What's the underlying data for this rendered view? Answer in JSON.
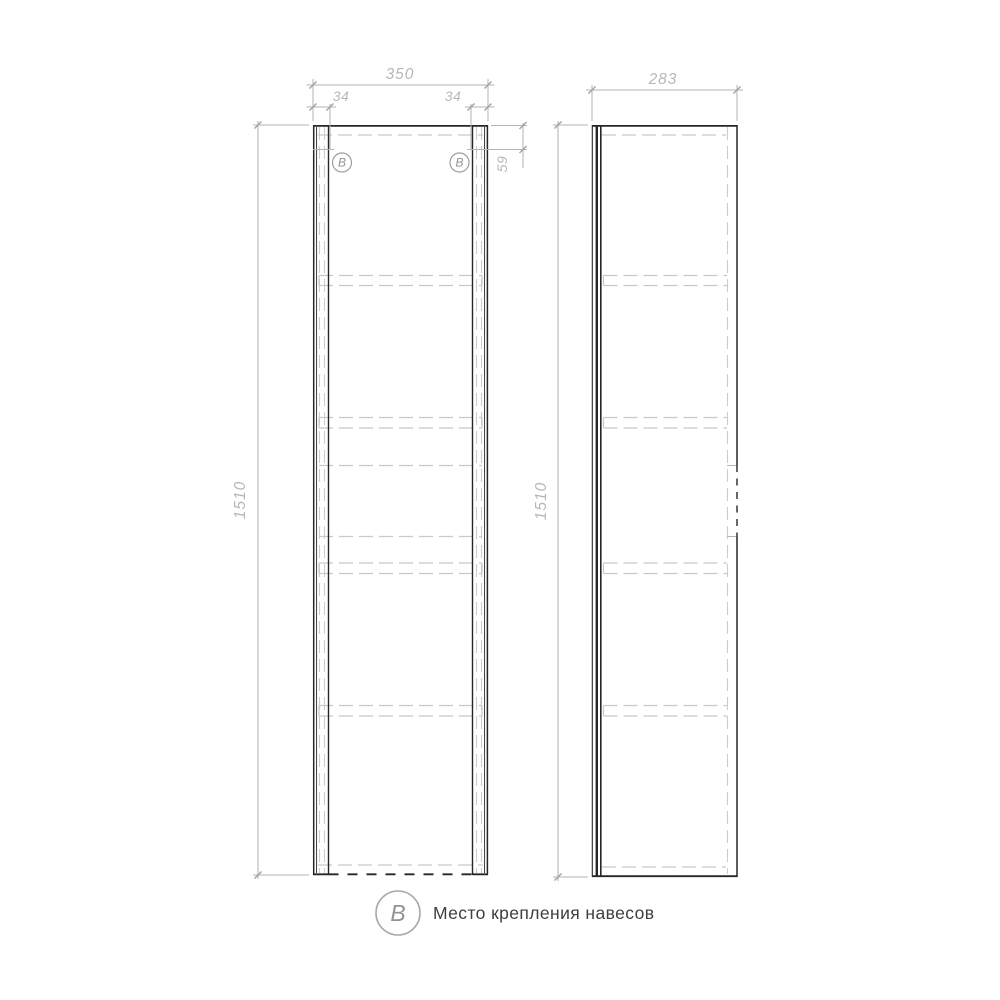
{
  "legend": {
    "symbol": "B",
    "label": "Место крепления навесов"
  },
  "front_view": {
    "width_mm": "350",
    "hole_offset_left_mm": "34",
    "hole_offset_right_mm": "34",
    "hole_top_offset_mm": "59",
    "height_mm": "1510",
    "balloon_left": "B",
    "balloon_right": "B"
  },
  "side_view": {
    "depth_mm": "283",
    "height_mm": "1510"
  },
  "colors": {
    "outline": "#262626",
    "hidden_line": "#c7c9ca",
    "dimension": "#b2b4b6",
    "legend_text": "#3e3e3e"
  }
}
